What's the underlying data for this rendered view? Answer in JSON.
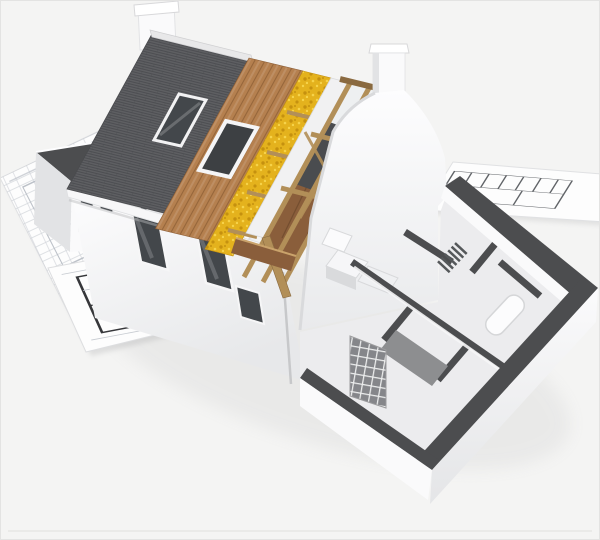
{
  "meta": {
    "title": "3D cutaway house construction model on blueprints",
    "alt": "3D render of a partially built house model, roof peeled back in layers, sitting on architectural floor plans",
    "description": "Photorealistic 3D architectural rendering of a cutaway house model: the roof is stripped in bands showing dark grey tiles, brown timber sheathing, yellow insulation and white membrane over exposed tan rafters; a white Dutch-gable end wall with chimneys; a white facade with dark windows and skylights; the ground floor is open-topped showing grey-capped interior walls, kitchen units, a bathtub and a brick block pillar; everything rests on white blueprint sheets with floor-plan line work."
  },
  "palette": {
    "bg": "#f4f4f3",
    "frame": "#e3e3e2",
    "paper": "#fdfdfd",
    "paper-shade": "#e7e8e9",
    "bp-line": "#b9bec6",
    "bp-bold": "#36373a",
    "wall-white": "#fafafb",
    "wall-shade": "#e2e3e5",
    "wall-dark-top": "#4c4d4f",
    "roof-tile": "#5e5f62",
    "roof-tile-line": "#4a4b4e",
    "wood-deck": "#b5804f",
    "wood-deck-line": "#8e5f36",
    "insulation": "#e4b21d",
    "insulation-dark": "#c5910f",
    "insulation-light": "#f6d34a",
    "membrane": "#f1f1f2",
    "rafter": "#b28f58",
    "rafter-edge": "#8a6a40",
    "attic-floor": "#8a5e3b",
    "attic-floor-line": "#6e4a2e",
    "glass": "#43474b",
    "floor": "#ececee",
    "fitting": "#d9dadc",
    "brick": "#85868a",
    "brick-joint": "#eceded",
    "shadow": "#8f9093"
  },
  "scene": {
    "elements": [
      "blueprint sheet (left)",
      "bold floor plan drawing",
      "blueprint sheet (right)",
      "left wing with dark parapet",
      "front facade",
      "facade windows",
      "roof tiles band",
      "timber sheathing band",
      "insulation band",
      "membrane band",
      "exposed rafters",
      "attic interior",
      "skylight",
      "open skylight frame",
      "ridge chimney",
      "gable chimney",
      "dutch gable wall",
      "ground-floor cutaway",
      "interior partition walls",
      "kitchen units",
      "bathtub",
      "radiator",
      "staircase slab",
      "brick block pillar",
      "downspout",
      "leaning timber board",
      "soft ground shadow"
    ]
  }
}
